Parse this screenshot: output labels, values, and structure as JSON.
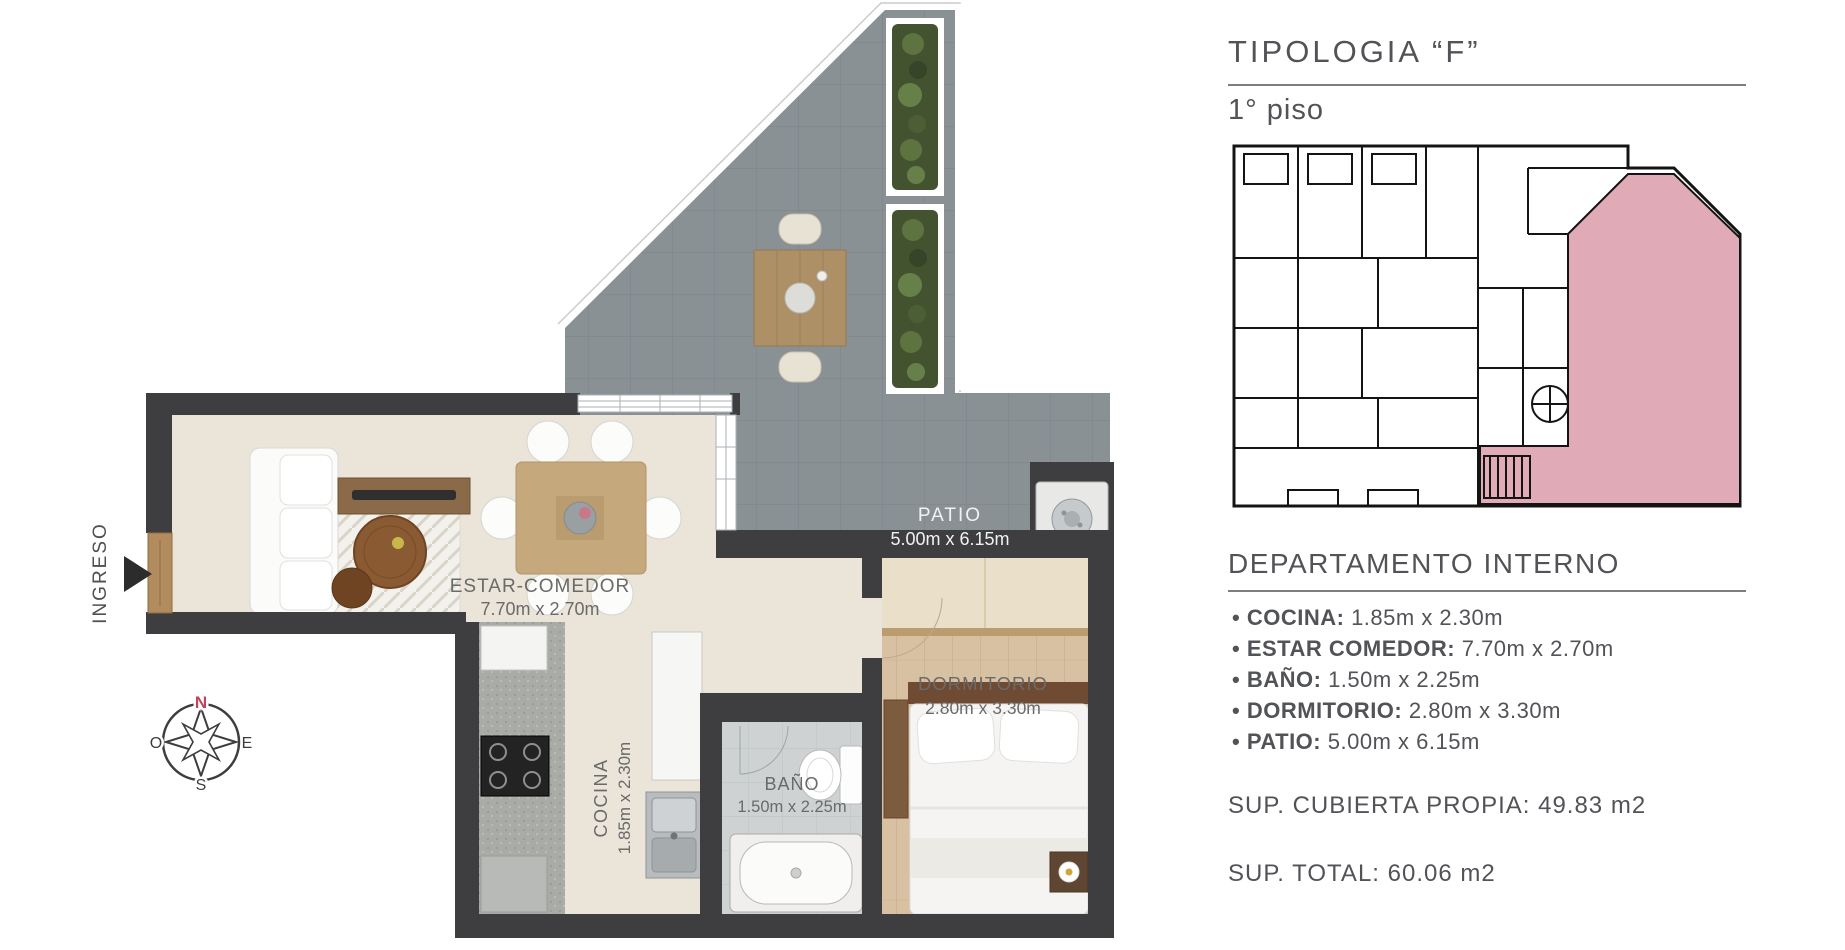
{
  "right_panel": {
    "title": "TIPOLOGIA “F”",
    "subtitle": "1° piso",
    "section_heading": "DEPARTAMENTO INTERNO",
    "rooms": [
      {
        "name": "COCINA:",
        "dims": "1.85m x 2.30m"
      },
      {
        "name": "ESTAR COMEDOR:",
        "dims": "7.70m x 2.70m"
      },
      {
        "name": "BAÑO:",
        "dims": "1.50m x 2.25m"
      },
      {
        "name": "DORMITORIO:",
        "dims": "2.80m x 3.30m"
      },
      {
        "name": "PATIO:",
        "dims": "5.00m x 6.15m"
      }
    ],
    "sup_cubierta": "SUP. CUBIERTA PROPIA: 49.83 m2",
    "sup_total": "SUP. TOTAL: 60.06 m2",
    "unit_highlight_color": "#e0aab7"
  },
  "floor_plan": {
    "labels": {
      "ingreso": "INGRESO",
      "estar_comedor": {
        "name": "ESTAR-COMEDOR",
        "dims": "7.70m x 2.70m"
      },
      "cocina": {
        "name": "COCINA",
        "dims": "1.85m x 2.30m"
      },
      "bano": {
        "name": "BAÑO",
        "dims": "1.50m x 2.25m"
      },
      "dormitorio": {
        "name": "DORMITORIO",
        "dims": "2.80m x 3.30m"
      },
      "patio": {
        "name": "PATIO",
        "dims": "5.00m x 6.15m"
      }
    },
    "compass": {
      "n": "N",
      "e": "E",
      "s": "S",
      "o": "O",
      "north_color": "#c0455a"
    },
    "colors": {
      "wall": "#3e3e40",
      "patio_floor": "#8a9195",
      "living_floor": "#eae4d9",
      "bedroom_floor": "#d8c1a3"
    }
  }
}
